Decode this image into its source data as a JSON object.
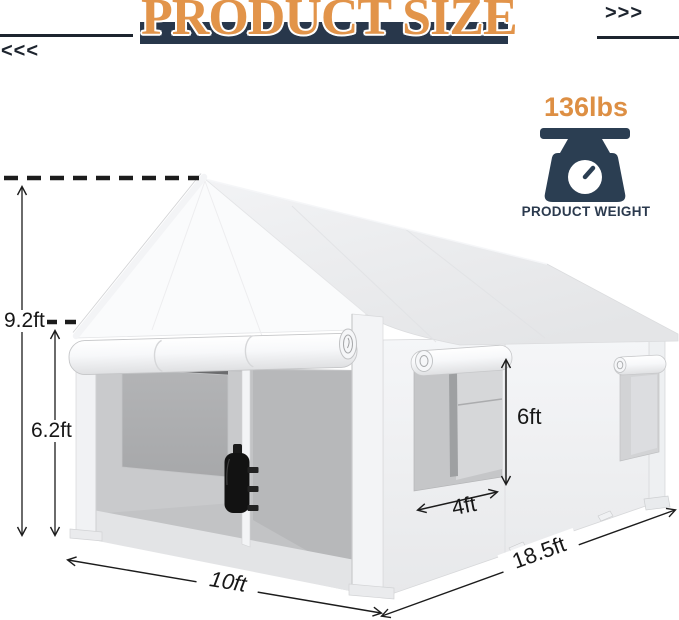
{
  "header": {
    "title": "PRODUCT SIZE",
    "left_chevrons": "<<<",
    "right_chevrons": ">>>",
    "accent_orange": "#E2944A",
    "bar_navy": "#28374B"
  },
  "weight": {
    "value": "136lbs",
    "label": "PRODUCT WEIGHT",
    "icon": "scale-icon",
    "value_color": "#DD8F44",
    "icon_color": "#2B3E52"
  },
  "dimensions": {
    "total_height": "9.2ft",
    "wall_height": "6.2ft",
    "window_height": "6ft",
    "window_width": "4ft",
    "front_width": "10ft",
    "side_length": "18.5ft"
  },
  "illustration": {
    "subject": "carport-canopy-tent",
    "parts": [
      "peaked-roof",
      "front-door-rolled-up",
      "side-window-large",
      "side-window-small",
      "sandbag-weight",
      "mesh-window"
    ]
  },
  "line_color": "#1C1C1C"
}
